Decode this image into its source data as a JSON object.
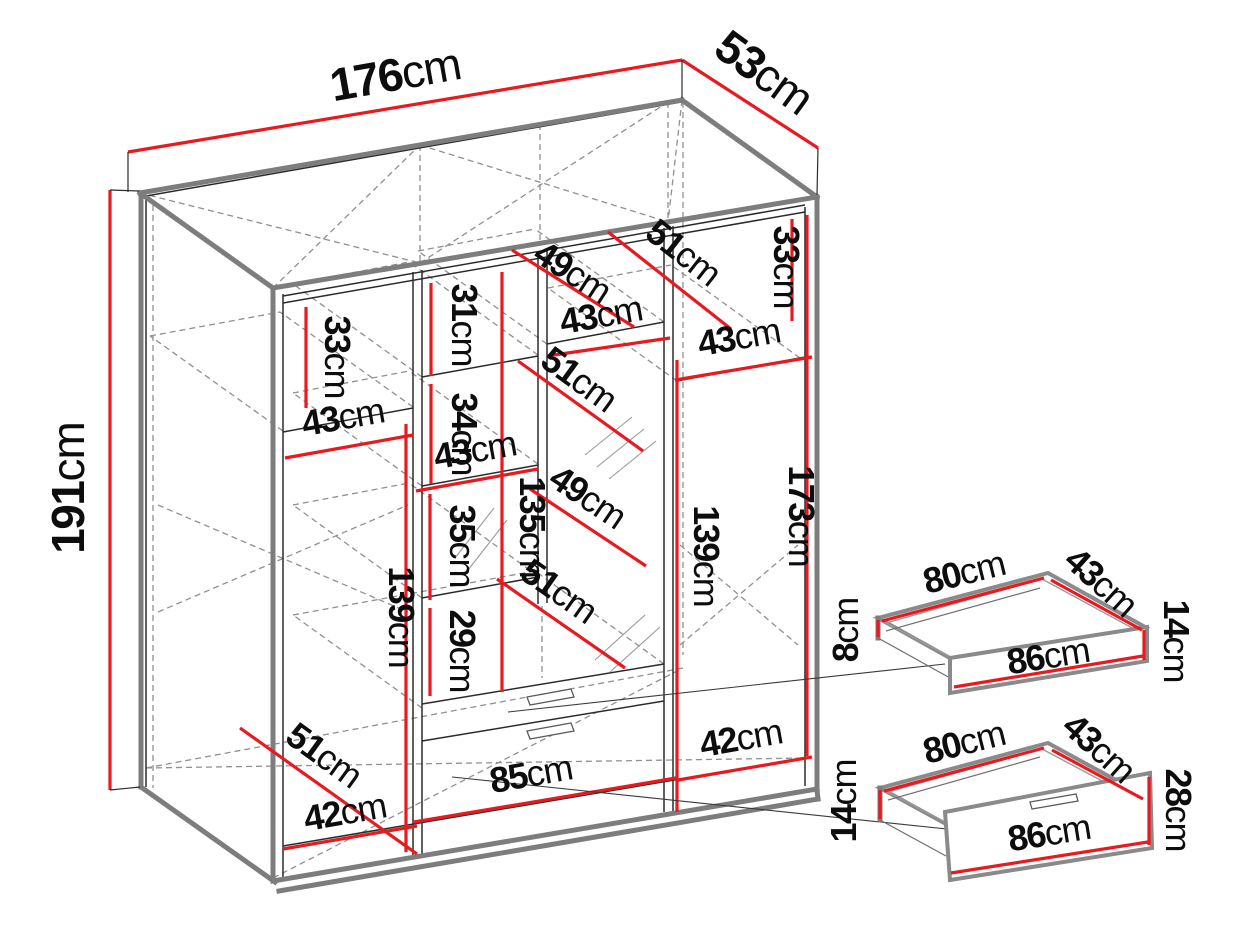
{
  "unit": "cm",
  "colors": {
    "dimension_red": "#e8191f",
    "structure_gray": "#7d7d7d",
    "line_black": "#2b2b2b",
    "hidden_gray": "#909090",
    "background": "#ffffff"
  },
  "wardrobe": {
    "overall": {
      "width": "176",
      "depth": "53",
      "height": "191"
    },
    "left_section": {
      "top_gap": "33",
      "shelf_width": "43",
      "lower_height": "139",
      "floor_depth": "51",
      "door_width": "42"
    },
    "middle_section": {
      "gap_1": "31",
      "gap_2": "34",
      "gap_3": "35",
      "gap_4": "29",
      "column_width": "43",
      "column_height": "135",
      "top_depth_a": "49",
      "top_depth_b": "51",
      "top_width": "43",
      "depth_a": "51",
      "depth_b": "49",
      "depth_c": "51",
      "right_height": "139",
      "floor_width": "85"
    },
    "right_section": {
      "top_gap": "33",
      "top_width": "43",
      "inner_height": "173",
      "floor_width": "42"
    }
  },
  "drawer_small": {
    "width": "80",
    "depth": "43",
    "back_height": "8",
    "front_height": "14",
    "front_width": "86"
  },
  "drawer_large": {
    "width": "80",
    "depth": "43",
    "back_height": "14",
    "front_height": "28",
    "front_width": "86"
  }
}
